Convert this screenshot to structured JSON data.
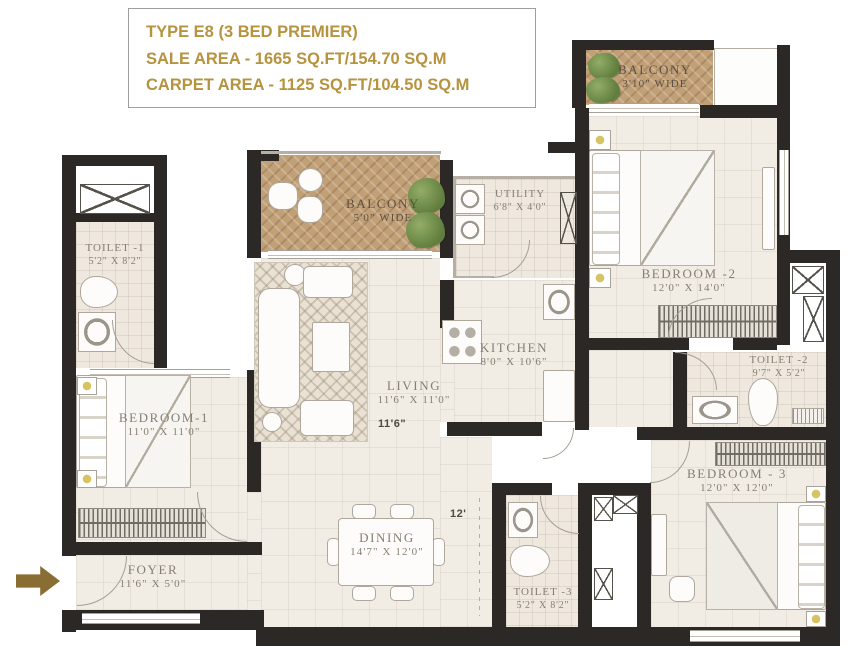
{
  "header": {
    "title": "TYPE E8 (3 BED PREMIER)",
    "sale_area": "SALE AREA - 1665 SQ.FT/154.70 SQ.M",
    "carpet_area": "CARPET AREA - 1125 SQ.FT/104.50 SQ.M"
  },
  "rooms": {
    "balcony_top": {
      "name": "BALCONY",
      "dim": "3'10\" WIDE"
    },
    "balcony_living": {
      "name": "BALCONY",
      "dim": "5'0\" WIDE"
    },
    "utility": {
      "name": "UTILITY",
      "dim": "6'8\" X 4'0\""
    },
    "kitchen": {
      "name": "KITCHEN",
      "dim": "8'0\" X 10'6\""
    },
    "living": {
      "name": "LIVING",
      "dim": "11'6\" X 11'0\""
    },
    "dining": {
      "name": "DINING",
      "dim": "14'7\" X 12'0\""
    },
    "foyer": {
      "name": "FOYER",
      "dim": "11'6\" X 5'0\""
    },
    "bedroom1": {
      "name": "BEDROOM-1",
      "dim": "11'0\" X 11'0\""
    },
    "bedroom2": {
      "name": "BEDROOM -2",
      "dim": "12'0\" X 14'0\""
    },
    "bedroom3": {
      "name": "BEDROOM - 3",
      "dim": "12'0\" X 12'0\""
    },
    "toilet1": {
      "name": "TOILET -1",
      "dim": "5'2\" X 8'2\""
    },
    "toilet2": {
      "name": "TOILET -2",
      "dim": "9'7\" X 5'2\""
    },
    "toilet3": {
      "name": "TOILET -3",
      "dim": "5'2\" X 8'2\""
    }
  },
  "floor_labels": {
    "living_width": "11'6\"",
    "dining_width": "12'"
  },
  "colors": {
    "accent_gold": "#b6933e",
    "wall": "#2b2826",
    "wood": "#c2a077",
    "floor": "#f1ece4",
    "plant_green": "#7d9b57",
    "entry_arrow": "#8a6d33"
  }
}
